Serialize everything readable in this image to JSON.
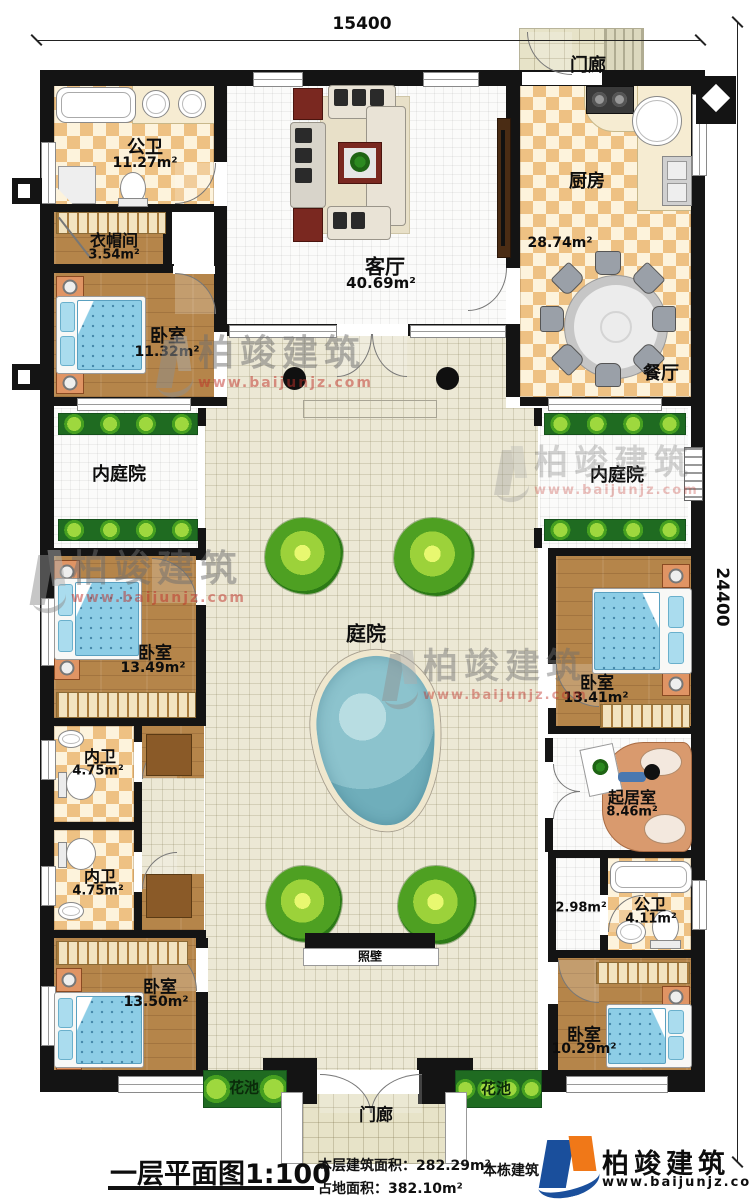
{
  "dimensions": {
    "width": "15400",
    "height": "24400"
  },
  "rooms": {
    "menlang_top": {
      "label": "门廊"
    },
    "gongwei_top": {
      "label": "公卫",
      "area": "11.27m²"
    },
    "yimaojian": {
      "label": "衣帽间",
      "area": "3.54m²"
    },
    "keting": {
      "label": "客厅",
      "area": "40.69m²"
    },
    "chufang": {
      "label": "厨房",
      "area": "28.74m²"
    },
    "canting": {
      "label": "餐厅"
    },
    "woshi1": {
      "label": "卧室",
      "area": "11.32m²"
    },
    "neitingyuan_left": {
      "label": "内庭院"
    },
    "neitingyuan_right": {
      "label": "内庭院"
    },
    "woshi2": {
      "label": "卧室",
      "area": "13.49m²"
    },
    "tingyuan": {
      "label": "庭院"
    },
    "woshi3": {
      "label": "卧室",
      "area": "13.41m²"
    },
    "neiwei1": {
      "label": "内卫",
      "area": "4.75m²"
    },
    "neiwei2": {
      "label": "内卫",
      "area": "4.75m²"
    },
    "qijushi": {
      "label": "起居室",
      "area": "8.46m²"
    },
    "hall": {
      "area": "2.98m²"
    },
    "gongwei_bottom": {
      "label": "公卫",
      "area": "4.11m²"
    },
    "zhaobi": {
      "label": "照壁"
    },
    "woshi4": {
      "label": "卧室",
      "area": "13.50m²"
    },
    "woshi5": {
      "label": "卧室",
      "area": "10.29m²"
    },
    "huachi_left": {
      "label": "花池"
    },
    "huachi_right": {
      "label": "花池"
    },
    "menlang_bottom": {
      "label": "门廊"
    }
  },
  "footer": {
    "title": "一层平面图",
    "scale": "1:100",
    "floor_area_label": "本层建筑面积：",
    "floor_area": "282.29m²",
    "land_area_label": "占地面积：",
    "land_area": "382.10m²",
    "building_label": "本栋建筑",
    "brand": "柏竣建筑",
    "website": "www.baijunjz.com"
  },
  "watermark": {
    "brand": "柏竣建筑",
    "website": "www.baijunjz.com"
  },
  "colors": {
    "wall": "#141414",
    "tile": "#eec183",
    "water": "#6faebb",
    "brand_blue": "#1a4f9c",
    "brand_orange": "#f07818",
    "wm_red": "#c03028"
  }
}
